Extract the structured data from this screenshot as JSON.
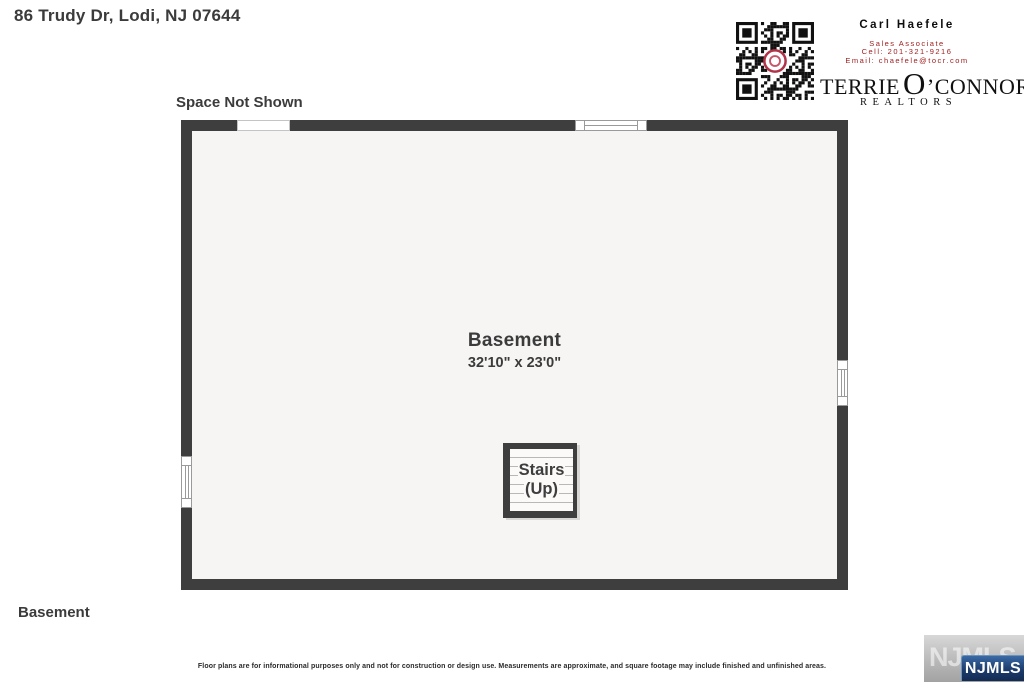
{
  "header": {
    "address": "86 Trudy Dr, Lodi, NJ 07644"
  },
  "agent": {
    "name": "Carl Haefele",
    "title": "Sales Associate",
    "cell": "Cell: 201-321-9216",
    "email": "Email: chaefele@tocr.com"
  },
  "brokerage": {
    "name_prefix": "TERRIE",
    "name_o": "O",
    "name_suffix": "’CONNOR",
    "subtitle": "REALTORS"
  },
  "floorplan": {
    "space_not_shown_label": "Space Not Shown",
    "room": {
      "name": "Basement",
      "dimensions": "32'10\" x 23'0\""
    },
    "stairs": {
      "line1": "Stairs",
      "line2": "(Up)"
    },
    "floor_label": "Basement"
  },
  "footer": {
    "disclaimer": "Floor plans are for informational purposes only and not for construction or design use. Measurements are approximate, and square footage may include finished and unfinished areas.",
    "watermark_text": "NJMLS",
    "watermark_faded_text": "NJMLS"
  },
  "colors": {
    "wall": "#3e3e3e",
    "floor_fill": "#f6f5f3",
    "contact_red": "#a02020",
    "qr_ring_red": "#b03348",
    "njmls_blue": "#1c3c6d",
    "text_dark": "#3b3b3b"
  }
}
